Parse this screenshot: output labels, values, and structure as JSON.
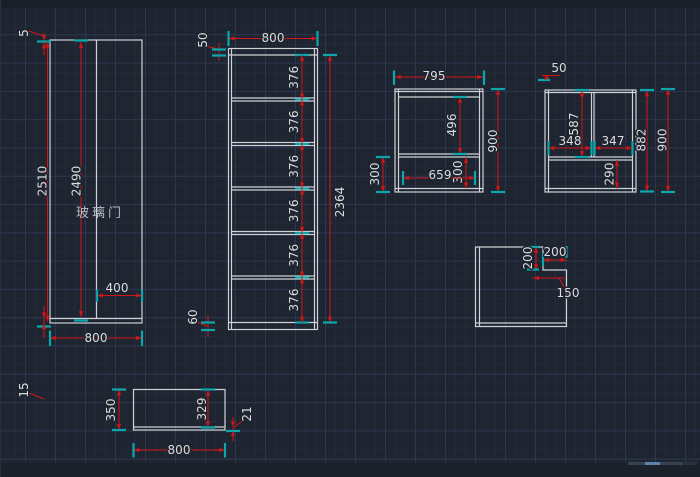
{
  "palette": {
    "background": "#1e2430",
    "grid_major": "#2c3750",
    "grid_minor": "#232a37",
    "geometry": "#cfd2d6",
    "dimension": "#d11616",
    "extension_tick": "#0aa8ad",
    "dim_text": "#dcdcdc",
    "label_text": "#b8bcc2",
    "scroll_thumb": "#5e83ad"
  },
  "views": {
    "glass_door_front": {
      "label": "玻璃门",
      "dims": {
        "top_gap": "5",
        "overall_height": "2510",
        "inner_height": "2490",
        "door_width": "400",
        "bottom_gap": "15",
        "width": "800"
      }
    },
    "cabinet_front": {
      "dims": {
        "width": "800",
        "top": "50",
        "total": "2364",
        "bottom": "60"
      },
      "shelf_sections": [
        "376",
        "376",
        "376",
        "376",
        "376",
        "376"
      ]
    },
    "side_view_a": {
      "dims": {
        "width": "795",
        "height": "900",
        "upper_height": "496",
        "lower_height": "300",
        "inner_width": "659",
        "left_height": "300"
      }
    },
    "side_view_b": {
      "dims": {
        "top": "50",
        "upper_height": "587",
        "left_width": "348",
        "right_width": "347",
        "inner_height": "882",
        "height": "900",
        "lower_height": "290"
      }
    },
    "notched_panel": {
      "dims": {
        "notch_depth": "200",
        "notch_width": "200",
        "offset": "150"
      }
    },
    "top_panel": {
      "dims": {
        "depth": "350",
        "inner_depth": "329",
        "thickness": "21",
        "width": "800"
      }
    }
  }
}
